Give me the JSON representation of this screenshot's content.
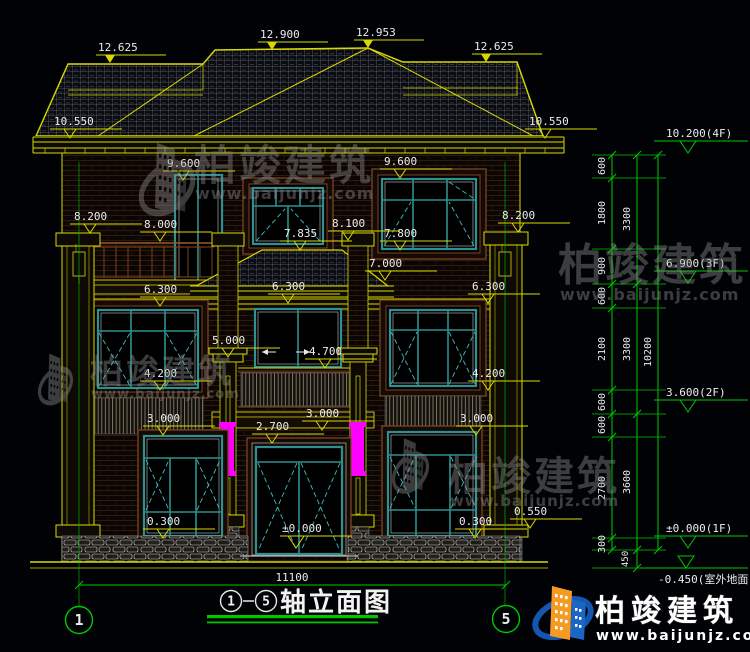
{
  "meta": {
    "type": "architectural-elevation-drawing"
  },
  "brand": {
    "name": "柏竣建筑",
    "url": "www.baijunjz.com"
  },
  "title": {
    "axis_start": "1",
    "dash": "-",
    "axis_end": "5",
    "text": "轴立面图"
  },
  "footer": {
    "overall_dim": "11100",
    "axis_left": "1",
    "axis_right": "5"
  },
  "labels": {
    "roof": [
      "12.625",
      "12.900",
      "12.953",
      "12.625"
    ],
    "facade": [
      "10.550",
      "10.550",
      "9.600",
      "9.600",
      "8.200",
      "8.000",
      "8.100",
      "8.200",
      "7.835",
      "7.800",
      "7.000",
      "6.300",
      "6.300",
      "6.300",
      "5.000",
      "4.700",
      "4.200",
      "4.200",
      "3.000",
      "3.000",
      "3.000",
      "2.700",
      "0.300",
      "0.300",
      "±0.000",
      "0.550"
    ]
  },
  "chain": {
    "segments_inner": [
      "600",
      "1800",
      "900",
      "600",
      "2100",
      "600",
      "600",
      "2700",
      "300"
    ],
    "segments_mid": [
      "3300",
      "3300",
      "3600"
    ],
    "segment_footing": "450",
    "total": "10200",
    "flags": [
      "10.200(4F)",
      "6.900(3F)",
      "3.600(2F)",
      "±0.000(1F)"
    ],
    "ground_flag": "-0.450(室外地面)"
  },
  "colors": {
    "background": "#000205",
    "line_yellow": "#d9d900",
    "line_green": "#00c800",
    "dim_text": "#ececec",
    "frame_teal": "#2e9090",
    "surround_brown": "#7a4526",
    "highlight_magenta": "#ff00ff",
    "brand_blue": "#1557b0",
    "brand_orange": "#f59a23",
    "watermark_gray": "#8f8f8f"
  }
}
